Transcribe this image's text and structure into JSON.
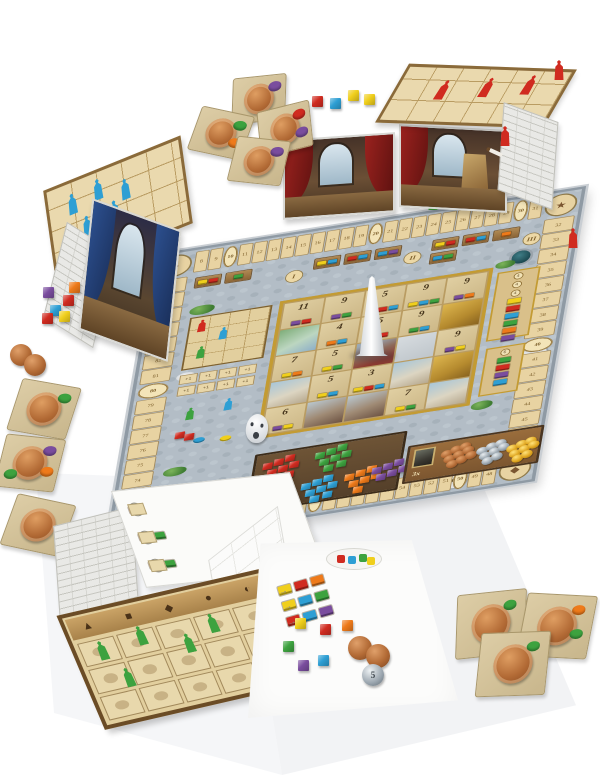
{
  "photo": {
    "background": "#ffffff",
    "subject": "Fresco board game components laid out on a white surface"
  },
  "palette": {
    "red": "#d02b20",
    "green": "#3da23f",
    "yellow": "#f0cf1c",
    "blue": "#2e9fd4",
    "orange": "#ee7a1a",
    "purple": "#7a4d9e",
    "copper": "#b26a35",
    "silver": "#9aa5ae",
    "gold": "#dfa51f",
    "stone": "#b3bdc6",
    "goldframe": "#c39b33"
  },
  "board": {
    "score_track": {
      "top": [
        "8",
        "9",
        "10",
        "11",
        "12",
        "13",
        "14",
        "15",
        "16",
        "17",
        "18",
        "19",
        "20",
        "21",
        "22",
        "23",
        "24",
        "25",
        "26",
        "27",
        "28",
        "29",
        "30",
        "31"
      ],
      "right": [
        "32",
        "33",
        "34",
        "35",
        "36",
        "37",
        "38",
        "39",
        "40",
        "41",
        "42",
        "43",
        "44",
        "45",
        "46",
        "47"
      ],
      "bottom": [
        "48",
        "49",
        "50",
        "51",
        "52",
        "53",
        "54",
        "55",
        "56",
        "57",
        "58",
        "59",
        "60",
        "61",
        "62",
        "63",
        "64",
        "65",
        "66",
        "67",
        "68",
        "69",
        "70",
        "71"
      ],
      "left": [
        "72",
        "73",
        "74",
        "75",
        "76",
        "77",
        "78",
        "79",
        "80",
        "81",
        "82",
        "83",
        "84",
        "85",
        "86",
        "87"
      ]
    },
    "corner_icons": [
      {
        "name": "palette-icon",
        "glyph": "●"
      },
      {
        "name": "painter-icon",
        "glyph": "★"
      },
      {
        "name": "easel-icon",
        "glyph": "◆"
      },
      {
        "name": "mask-icon",
        "glyph": "◐"
      },
      {
        "name": "monk-icon",
        "glyph": "▲"
      },
      {
        "name": "easel2-icon",
        "glyph": "◆"
      }
    ],
    "market": {
      "sections": [
        {
          "label": "I",
          "stalls": [
            [
              "yellow",
              "red"
            ],
            [
              "green"
            ]
          ]
        },
        {
          "label": "II",
          "stalls": [
            [
              "yellow",
              "blue"
            ],
            [
              "red",
              "blue"
            ],
            [
              "blue",
              "purple"
            ]
          ]
        },
        {
          "label": "III",
          "stalls": [
            [
              "yellow",
              "red"
            ],
            [
              "red",
              "blue"
            ],
            [
              "orange"
            ],
            [
              "blue",
              "green"
            ]
          ]
        }
      ]
    },
    "fresco": {
      "tiles": [
        {
          "n": "11",
          "c": [
            "purple",
            "red"
          ]
        },
        {
          "n": "9",
          "c": [
            "purple",
            "green"
          ]
        },
        {
          "n": "5",
          "c": [
            "orange",
            "red",
            "blue"
          ]
        },
        {
          "n": "9",
          "c": [
            "yellow",
            "blue",
            "green"
          ]
        },
        {
          "n": "9",
          "c": [
            "purple",
            "orange"
          ]
        },
        {
          "a": "green"
        },
        {
          "n": "4",
          "c": [
            "orange",
            "blue"
          ]
        },
        {
          "n": "5",
          "c": [
            "yellow",
            "red"
          ]
        },
        {
          "n": "9",
          "c": [
            "green",
            "blue"
          ]
        },
        {
          "a": "gold"
        },
        {
          "n": "7",
          "c": [
            "yellow",
            "orange"
          ]
        },
        {
          "n": "5",
          "c": [
            "yellow",
            "green"
          ]
        },
        {
          "a": "red"
        },
        {
          "a": "bishop"
        },
        {
          "n": "9",
          "c": [
            "purple",
            "yellow"
          ]
        },
        {
          "a": "sky"
        },
        {
          "n": "5",
          "c": [
            "yellow",
            "blue"
          ]
        },
        {
          "n": "3",
          "c": [
            "yellow",
            "red",
            "blue"
          ]
        },
        {
          "a": "sky"
        },
        {
          "a": "gold"
        },
        {
          "n": "6",
          "c": [
            "purple",
            "yellow"
          ]
        },
        {
          "a": "crowd"
        },
        {
          "a": "crowd"
        },
        {
          "n": "7",
          "c": [
            "yellow",
            "green"
          ]
        },
        {
          "a": "sky"
        }
      ]
    },
    "portals": [
      {
        "prices": [
          "4",
          "4",
          "4"
        ],
        "tiles": [
          "yellow",
          "red",
          "blue",
          "green",
          "orange",
          "purple"
        ]
      },
      {
        "prices": [
          "6"
        ],
        "tiles": [
          "green",
          "red",
          "purple",
          "blue"
        ]
      }
    ],
    "bishop_track": {
      "meeples": [
        "red",
        "blue",
        "green"
      ]
    },
    "courtyard": {
      "plus_label": "+1",
      "plus_count": 8,
      "meeples": [
        "green",
        "blue"
      ],
      "discs": [
        "blue",
        "yellow"
      ],
      "cubes": [
        "red",
        "red"
      ]
    },
    "paint_market": {
      "groups": [
        {
          "color": "red",
          "count": 8
        },
        {
          "color": "green",
          "count": 8
        },
        {
          "color": "yellow",
          "count": 8
        },
        {
          "color": "blue",
          "count": 8
        },
        {
          "color": "orange",
          "count": 7
        },
        {
          "color": "purple",
          "count": 6
        }
      ]
    },
    "bank": {
      "multiplier_label": "3x",
      "piles": [
        {
          "metal": "copper",
          "count": 9
        },
        {
          "metal": "silver",
          "count": 8
        },
        {
          "metal": "gold",
          "count": 8
        }
      ]
    },
    "track_meeples": [
      "green",
      "blue",
      "red"
    ]
  },
  "screens": {
    "arrow_glyph": "→",
    "blue": {
      "meeples": [
        "blue",
        "blue",
        "blue",
        "blue",
        "blue"
      ]
    },
    "center_cubes": [
      "red",
      "blue",
      "yellow",
      "yellow"
    ],
    "red": {
      "meeples": [
        "red",
        "red",
        "red"
      ]
    },
    "green": {
      "meeples": [
        "green",
        "green",
        "green",
        "green",
        "green"
      ],
      "header_icons": [
        {
          "name": "pigment-stall-icon",
          "glyph": "▲"
        },
        {
          "name": "cathedral-icon",
          "glyph": "■"
        },
        {
          "name": "easel-icon",
          "glyph": "◆"
        },
        {
          "name": "paint-pots-icon",
          "glyph": "●"
        },
        {
          "name": "mask-icon",
          "glyph": "◐"
        }
      ],
      "aid_steps": [
        {
          "n": "1",
          "chips": [
            "red"
          ]
        },
        {
          "n": "2",
          "chips": [
            "red",
            "green"
          ]
        },
        {
          "n": "3",
          "chips": [
            "orange",
            "green"
          ]
        }
      ]
    },
    "back_mix_rows": [
      [
        "yellow",
        "red",
        "orange"
      ],
      [
        "yellow",
        "blue",
        "green"
      ],
      [
        "red",
        "blue",
        "purple"
      ]
    ]
  },
  "loose": {
    "top_tiles": [
      {
        "blobs": [
          "purple"
        ]
      },
      {
        "blobs": [
          "green",
          "orange"
        ]
      },
      {
        "blobs": [
          "red",
          "purple"
        ]
      },
      {
        "blobs": [
          "purple"
        ]
      }
    ],
    "left_cubes": [
      "purple",
      "orange",
      "red",
      "blue",
      "yellow",
      "red"
    ],
    "left_coins": 2,
    "left_tiles": [
      {
        "blobs": [
          "green"
        ]
      },
      {
        "blobs": [
          "purple",
          "orange",
          "green"
        ]
      },
      {
        "blobs": []
      }
    ],
    "right_tiles": [
      {
        "blobs": [
          "green"
        ]
      },
      {
        "blobs": [
          "orange",
          "green"
        ]
      },
      {
        "blobs": [
          "green"
        ]
      }
    ],
    "bottom_cubes": [
      "yellow",
      "red",
      "orange",
      "green",
      "blue",
      "purple"
    ],
    "bottom_coins": {
      "copper": 2,
      "silver_value": "5"
    },
    "red_meeples": [
      "red",
      "red"
    ],
    "paintbrush": true
  }
}
